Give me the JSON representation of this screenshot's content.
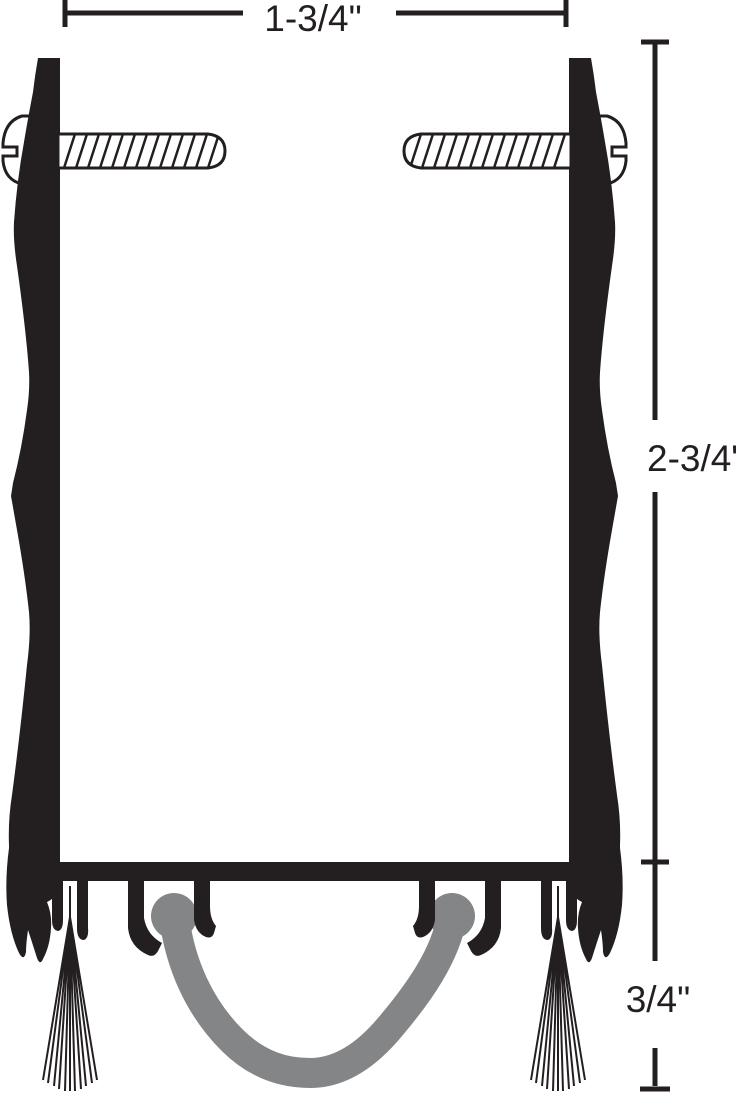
{
  "diagram": {
    "name": "Door bottom sweep cross-section",
    "labels": {
      "width": "1-3/4\"",
      "height": "2-3/4\"",
      "drop": "3/4\""
    },
    "colors": {
      "ink": "#231f20",
      "seal_gray": "#838587",
      "background": "#ffffff"
    }
  }
}
